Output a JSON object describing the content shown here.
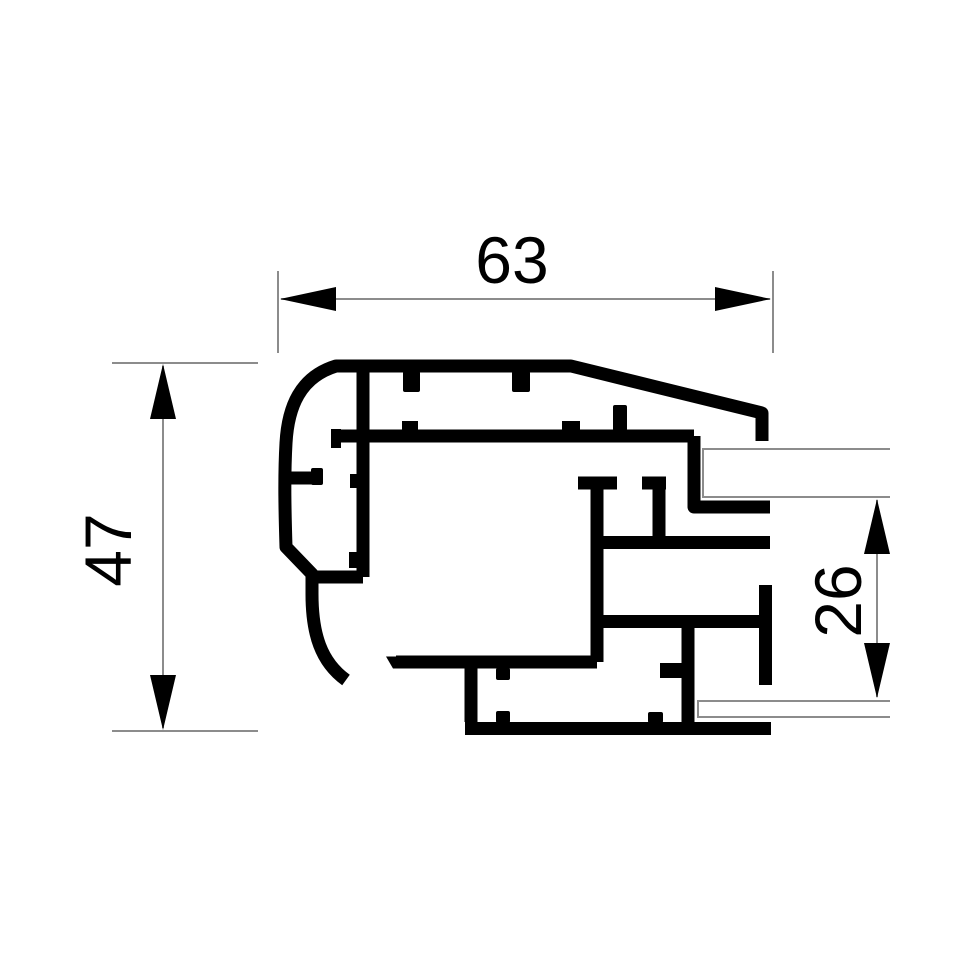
{
  "drawing": {
    "dimensions": {
      "width": {
        "label": "63"
      },
      "height": {
        "label": "47"
      },
      "glazing_step": {
        "label": "26"
      }
    },
    "colors": {
      "background": "#ffffff",
      "profile": "#000000",
      "dimension_line": "#8c8c8c",
      "panel_line": "#8c8c8c",
      "text": "#000000"
    }
  }
}
